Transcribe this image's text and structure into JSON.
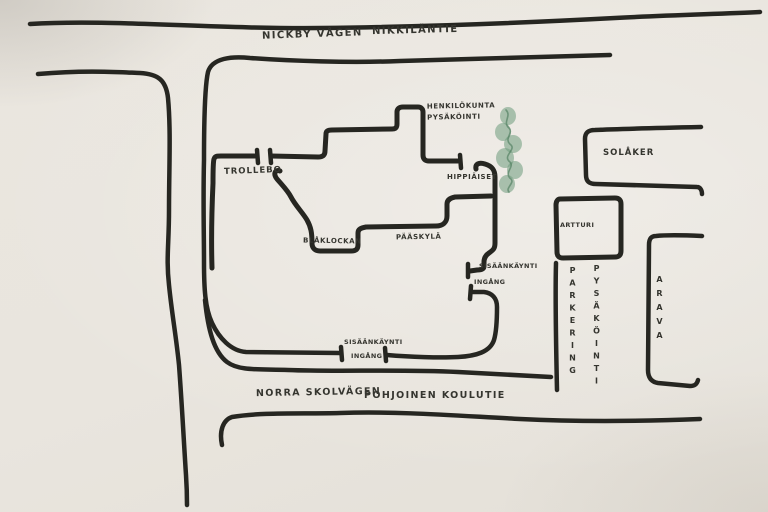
{
  "roads": {
    "top": {
      "name_sv": "NICKBY VÅGEN",
      "name_fi": "NIKKILÄNTIE"
    },
    "bottom": {
      "name_sv": "NORRA SKOLVÄGEN",
      "name_fi": "POHJOINEN KOULUTIE"
    }
  },
  "buildings": {
    "trollebo": "TROLLEBO",
    "blaklockan": "BLÅKLOCKAN",
    "paaskyla": "PÄÄSKYLÄ",
    "hippiaiset": "HIPPIÄISET",
    "solaker": "SOLÅKER",
    "artturi": "ARTTURI",
    "arava": "ARAVA"
  },
  "parking": {
    "staff_line1": "HENKILÖKUNTA",
    "staff_line2": "PYSÄKÖINTI",
    "visitor_sv": "PARKERING",
    "visitor_fi": "PYSÄKÖINTI"
  },
  "entrances": {
    "right_line1": "SISÄÄNKÄYNTI",
    "right_line2": "INGÅNG",
    "bottom_line1": "SISÄÄNKÄYNTI",
    "bottom_line2": "INGÅNG"
  },
  "icons": {
    "tree": "tree-icon"
  },
  "colors": {
    "ink": "#262621",
    "paper": "#e9e5de",
    "tree_green": "#6d9b7c"
  }
}
